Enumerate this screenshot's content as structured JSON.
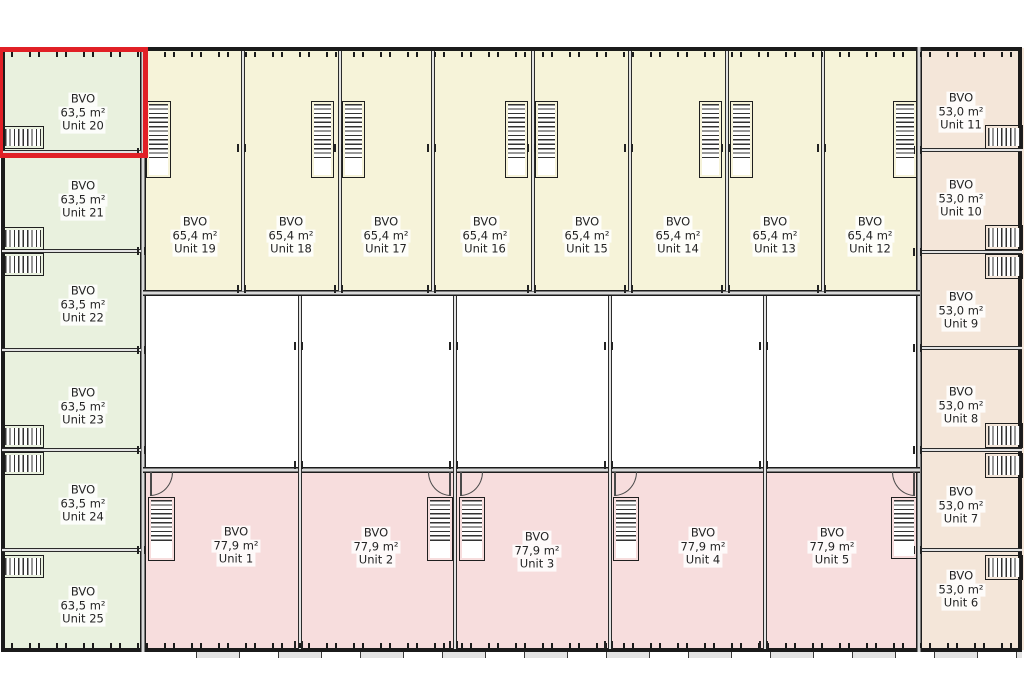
{
  "plan": {
    "bvo_label": "BVO",
    "highlight_color": "#e12026",
    "colors": {
      "green": "#e9f1de",
      "cream": "#f6f3d9",
      "pink": "#f7dddd",
      "peach": "#f4e6d9",
      "wall": "#1b1b1b",
      "text": "#242424"
    },
    "units": [
      {
        "id": "1",
        "name": "Unit 1",
        "area": "77,9 m²",
        "group": "pink",
        "x": 143,
        "y": 470,
        "w": 157,
        "h": 180,
        "cx": 236,
        "cy": 546
      },
      {
        "id": "2",
        "name": "Unit 2",
        "area": "77,9 m²",
        "group": "pink",
        "x": 300,
        "y": 470,
        "w": 155,
        "h": 180,
        "cx": 376,
        "cy": 547
      },
      {
        "id": "3",
        "name": "Unit 3",
        "area": "77,9 m²",
        "group": "pink",
        "x": 455,
        "y": 470,
        "w": 155,
        "h": 180,
        "cx": 537,
        "cy": 551
      },
      {
        "id": "4",
        "name": "Unit 4",
        "area": "77,9 m²",
        "group": "pink",
        "x": 610,
        "y": 470,
        "w": 155,
        "h": 180,
        "cx": 703,
        "cy": 547
      },
      {
        "id": "5",
        "name": "Unit 5",
        "area": "77,9 m²",
        "group": "pink",
        "x": 765,
        "y": 470,
        "w": 155,
        "h": 180,
        "cx": 832,
        "cy": 547
      },
      {
        "id": "6",
        "name": "Unit 6",
        "area": "53,0 m²",
        "group": "peach",
        "x": 920,
        "y": 550,
        "w": 104,
        "h": 100,
        "cx": 961,
        "cy": 590
      },
      {
        "id": "7",
        "name": "Unit 7",
        "area": "53,0 m²",
        "group": "peach",
        "x": 920,
        "y": 450,
        "w": 104,
        "h": 100,
        "cx": 961,
        "cy": 506
      },
      {
        "id": "8",
        "name": "Unit 8",
        "area": "53,0 m²",
        "group": "peach",
        "x": 920,
        "y": 348,
        "w": 104,
        "h": 102,
        "cx": 961,
        "cy": 406
      },
      {
        "id": "9",
        "name": "Unit 9",
        "area": "53,0 m²",
        "group": "peach",
        "x": 920,
        "y": 252,
        "w": 104,
        "h": 96,
        "cx": 961,
        "cy": 311
      },
      {
        "id": "10",
        "name": "Unit 10",
        "area": "53,0 m²",
        "group": "peach",
        "x": 920,
        "y": 150,
        "w": 104,
        "h": 102,
        "cx": 961,
        "cy": 199
      },
      {
        "id": "11",
        "name": "Unit 11",
        "area": "53,0 m²",
        "group": "peach",
        "x": 920,
        "y": 48,
        "w": 104,
        "h": 102,
        "cx": 961,
        "cy": 112
      },
      {
        "id": "12",
        "name": "Unit 12",
        "area": "65,4 m²",
        "group": "cream",
        "x": 823,
        "y": 50,
        "w": 97,
        "h": 243,
        "cx": 870,
        "cy": 236
      },
      {
        "id": "13",
        "name": "Unit 13",
        "area": "65,4 m²",
        "group": "cream",
        "x": 727,
        "y": 50,
        "w": 96,
        "h": 243,
        "cx": 775,
        "cy": 236
      },
      {
        "id": "14",
        "name": "Unit 14",
        "area": "65,4 m²",
        "group": "cream",
        "x": 630,
        "y": 50,
        "w": 97,
        "h": 243,
        "cx": 678,
        "cy": 236
      },
      {
        "id": "15",
        "name": "Unit 15",
        "area": "65,4 m²",
        "group": "cream",
        "x": 533,
        "y": 50,
        "w": 97,
        "h": 243,
        "cx": 587,
        "cy": 236
      },
      {
        "id": "16",
        "name": "Unit 16",
        "area": "65,4 m²",
        "group": "cream",
        "x": 433,
        "y": 50,
        "w": 100,
        "h": 243,
        "cx": 485,
        "cy": 236
      },
      {
        "id": "17",
        "name": "Unit 17",
        "area": "65,4 m²",
        "group": "cream",
        "x": 340,
        "y": 50,
        "w": 93,
        "h": 243,
        "cx": 386,
        "cy": 236
      },
      {
        "id": "18",
        "name": "Unit 18",
        "area": "65,4 m²",
        "group": "cream",
        "x": 243,
        "y": 50,
        "w": 97,
        "h": 243,
        "cx": 291,
        "cy": 236
      },
      {
        "id": "19",
        "name": "Unit 19",
        "area": "65,4 m²",
        "group": "cream",
        "x": 143,
        "y": 50,
        "w": 100,
        "h": 243,
        "cx": 195,
        "cy": 236
      },
      {
        "id": "20",
        "name": "Unit 20",
        "area": "63,5 m²",
        "group": "green",
        "x": 2,
        "y": 50,
        "w": 141,
        "h": 102,
        "cx": 83,
        "cy": 113,
        "selected": true
      },
      {
        "id": "21",
        "name": "Unit 21",
        "area": "63,5 m²",
        "group": "green",
        "x": 2,
        "y": 152,
        "w": 141,
        "h": 99,
        "cx": 83,
        "cy": 200
      },
      {
        "id": "22",
        "name": "Unit 22",
        "area": "63,5 m²",
        "group": "green",
        "x": 2,
        "y": 251,
        "w": 141,
        "h": 99,
        "cx": 83,
        "cy": 305
      },
      {
        "id": "23",
        "name": "Unit 23",
        "area": "63,5 m²",
        "group": "green",
        "x": 2,
        "y": 350,
        "w": 141,
        "h": 100,
        "cx": 83,
        "cy": 407
      },
      {
        "id": "24",
        "name": "Unit 24",
        "area": "63,5 m²",
        "group": "green",
        "x": 2,
        "y": 450,
        "w": 141,
        "h": 100,
        "cx": 83,
        "cy": 504
      },
      {
        "id": "25",
        "name": "Unit 25",
        "area": "63,5 m²",
        "group": "green",
        "x": 2,
        "y": 550,
        "w": 141,
        "h": 100,
        "cx": 83,
        "cy": 606
      }
    ],
    "stairs": [
      {
        "x": 146,
        "y": 101,
        "w": 25,
        "h": 77,
        "o": "v",
        "land": 56
      },
      {
        "x": 311,
        "y": 101,
        "w": 23,
        "h": 77,
        "o": "v",
        "land": 56
      },
      {
        "x": 342,
        "y": 101,
        "w": 23,
        "h": 77,
        "o": "v",
        "land": 56
      },
      {
        "x": 505,
        "y": 101,
        "w": 23,
        "h": 77,
        "o": "v",
        "land": 56
      },
      {
        "x": 535,
        "y": 101,
        "w": 23,
        "h": 77,
        "o": "v",
        "land": 56
      },
      {
        "x": 699,
        "y": 101,
        "w": 23,
        "h": 77,
        "o": "v",
        "land": 56
      },
      {
        "x": 730,
        "y": 101,
        "w": 23,
        "h": 77,
        "o": "v",
        "land": 56
      },
      {
        "x": 893,
        "y": 101,
        "w": 24,
        "h": 77,
        "o": "v",
        "land": 56
      },
      {
        "x": 2,
        "y": 126,
        "w": 42,
        "h": 23,
        "o": "h"
      },
      {
        "x": 2,
        "y": 227,
        "w": 42,
        "h": 23,
        "o": "h"
      },
      {
        "x": 2,
        "y": 253,
        "w": 42,
        "h": 23,
        "o": "h"
      },
      {
        "x": 2,
        "y": 425,
        "w": 42,
        "h": 23,
        "o": "h"
      },
      {
        "x": 2,
        "y": 452,
        "w": 42,
        "h": 23,
        "o": "h"
      },
      {
        "x": 2,
        "y": 555,
        "w": 42,
        "h": 23,
        "o": "h"
      },
      {
        "x": 985,
        "y": 125,
        "w": 38,
        "h": 24,
        "o": "h"
      },
      {
        "x": 985,
        "y": 225,
        "w": 38,
        "h": 25,
        "o": "h"
      },
      {
        "x": 985,
        "y": 254,
        "w": 38,
        "h": 25,
        "o": "h"
      },
      {
        "x": 985,
        "y": 423,
        "w": 38,
        "h": 25,
        "o": "h"
      },
      {
        "x": 985,
        "y": 453,
        "w": 38,
        "h": 25,
        "o": "h"
      },
      {
        "x": 985,
        "y": 555,
        "w": 38,
        "h": 25,
        "o": "h"
      },
      {
        "x": 148,
        "y": 497,
        "w": 27,
        "h": 64,
        "o": "v",
        "land": 42
      },
      {
        "x": 427,
        "y": 497,
        "w": 26,
        "h": 64,
        "o": "v",
        "land": 42
      },
      {
        "x": 459,
        "y": 497,
        "w": 26,
        "h": 64,
        "o": "v",
        "land": 42
      },
      {
        "x": 613,
        "y": 497,
        "w": 26,
        "h": 64,
        "o": "v",
        "land": 42
      },
      {
        "x": 891,
        "y": 497,
        "w": 26,
        "h": 62,
        "o": "v",
        "land": 42
      }
    ],
    "doors": [
      {
        "x": 150,
        "y": 472,
        "w": 23,
        "h": 24,
        "flip": false
      },
      {
        "x": 428,
        "y": 472,
        "w": 23,
        "h": 24,
        "flip": true
      },
      {
        "x": 460,
        "y": 472,
        "w": 23,
        "h": 24,
        "flip": false
      },
      {
        "x": 614,
        "y": 472,
        "w": 23,
        "h": 24,
        "flip": false
      },
      {
        "x": 892,
        "y": 472,
        "w": 23,
        "h": 24,
        "flip": true
      }
    ]
  }
}
